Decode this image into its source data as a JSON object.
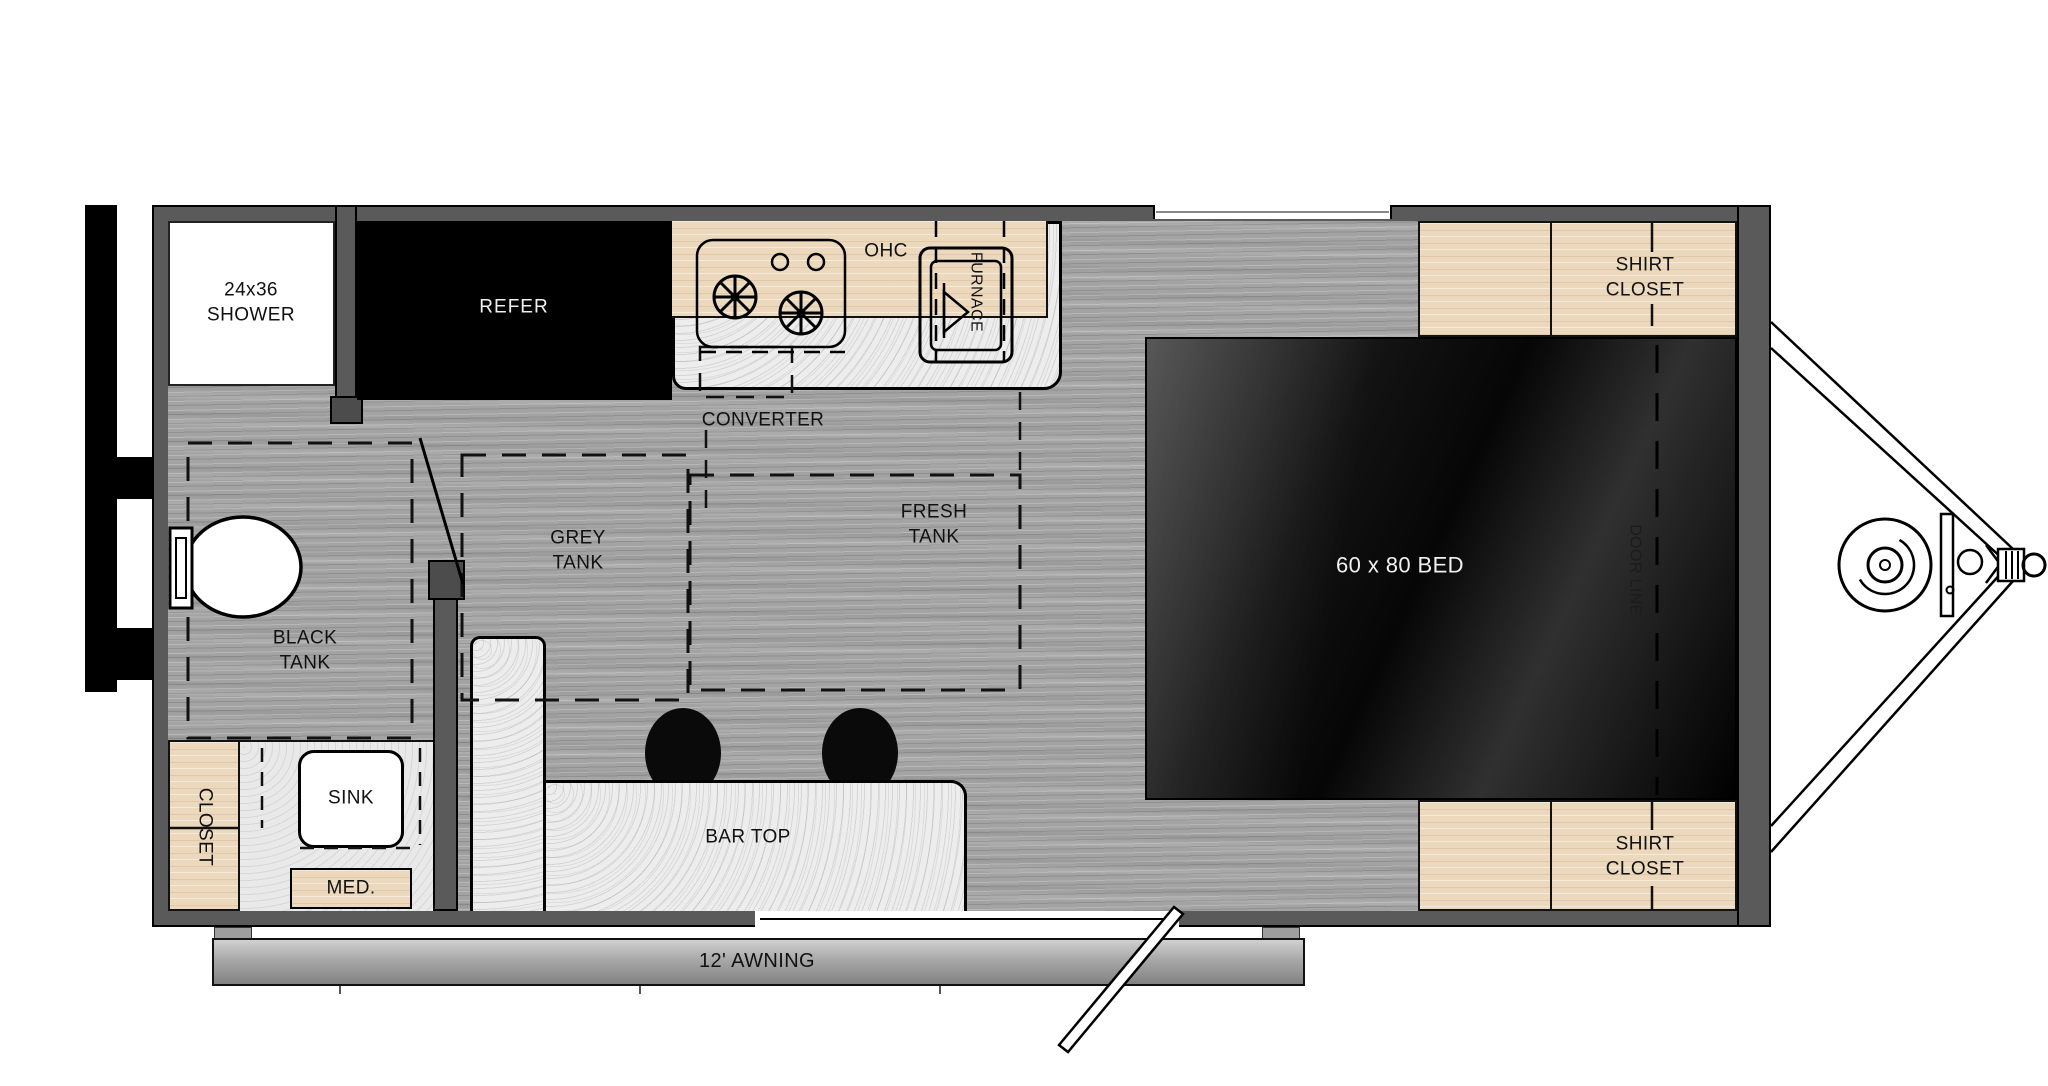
{
  "plan": {
    "title": "travel trailer floor plan",
    "labels": {
      "shower": "24x36\nSHOWER",
      "refer": "REFER",
      "ohc": "OHC",
      "furnace": "FURNACE",
      "converter": "CONVERTER",
      "fresh_tank": "FRESH\nTANK",
      "grey_tank": "GREY\nTANK",
      "black_tank": "BLACK\nTANK",
      "closet": "CLOSET",
      "sink": "SINK",
      "med": "MED.",
      "bar_top": "BAR TOP",
      "bed": "60 x 80 BED",
      "door_line": "DOOR LINE",
      "shirt_closet_top": "SHIRT\nCLOSET",
      "shirt_closet_bottom": "SHIRT\nCLOSET",
      "awning": "12' AWNING"
    },
    "colors": {
      "wall": "#5a5a5a",
      "floor_wood": "#a3a3a3",
      "cabinet_wood": "#ecd9bd",
      "countertop": "#ededed",
      "refrigerator": "#000000",
      "bed_dark": "#151515",
      "awning_grey": "#a8a8a8",
      "line": "#000000"
    }
  }
}
